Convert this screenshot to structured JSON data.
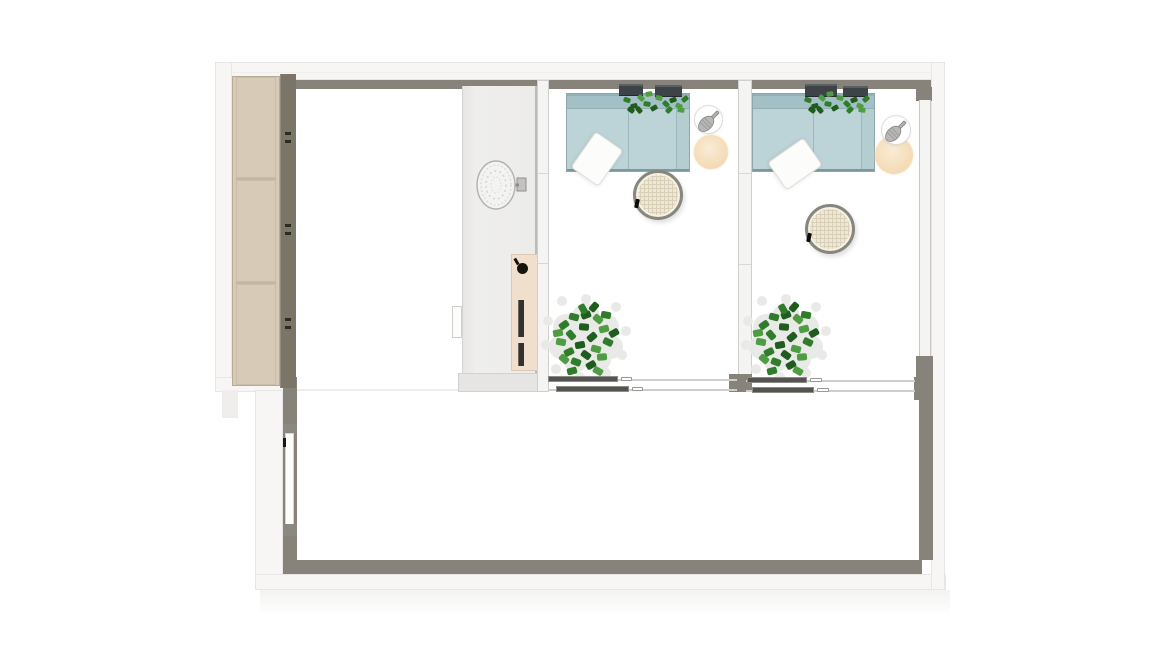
{
  "scene": {
    "title": "Top-down floor plan render of a suite: wardrobe hall, partition with mirror and control panel, two identical lounge rooms with teal sofas, rattan coffee tables, lantern side tables and plants, sliding glass doors, and a large lower room with an entry door",
    "background": "#ffffff"
  },
  "colors": {
    "wall_white": "#f7f6f5",
    "wall_line": "#e7e6e4",
    "wall_face": "#87837a",
    "cabinet_front": "#d7cab6",
    "cabinet_frame": "#b5aa96",
    "cabinet_side": "#7b7568",
    "panel_beige": "#f0dfcd",
    "knob_black": "#16130f",
    "sofa_back": "#a2c0c5",
    "sofa_seat": "#bcd4d7",
    "sofa_line": "#8fa7ab",
    "planter_box": "#3e4347",
    "leaf_dark": "#1f5c1d",
    "leaf_mid": "#2f7d2a",
    "leaf_light": "#4f9d43",
    "leaf_pale": "#e9e9e7",
    "rattan_fill": "#efe8d7",
    "rattan_grid": "#d9cfb6",
    "rattan_ring": "#87877f",
    "peach_light": "#f9ecd6",
    "peach": "#f2d6ac",
    "card_white": "#fcfcfb",
    "track_dark": "#55534f",
    "track_line": "#d0cecb",
    "glass_white": "#f4f4f2",
    "door_gray": "#8b8882"
  },
  "plan": {
    "regions": [
      {
        "name": "storage-hall",
        "items": [
          "wardrobe-3-doors",
          "partition-wall",
          "wall-mirror",
          "control-panel"
        ]
      },
      {
        "name": "lounge-room-1",
        "items": [
          "teal-sofa",
          "wall-planters",
          "tilted-card-table",
          "decor-table-with-vase",
          "lantern-side-table",
          "rattan-coffee-table",
          "floor-plant",
          "sliding-glass-door"
        ]
      },
      {
        "name": "lounge-room-2",
        "items": [
          "teal-sofa",
          "wall-planters",
          "tilted-card-table",
          "decor-table-with-vase",
          "lantern-side-table",
          "rattan-coffee-table",
          "floor-plant",
          "sliding-glass-door"
        ]
      },
      {
        "name": "lower-room",
        "items": [
          "entry-door"
        ]
      }
    ]
  }
}
